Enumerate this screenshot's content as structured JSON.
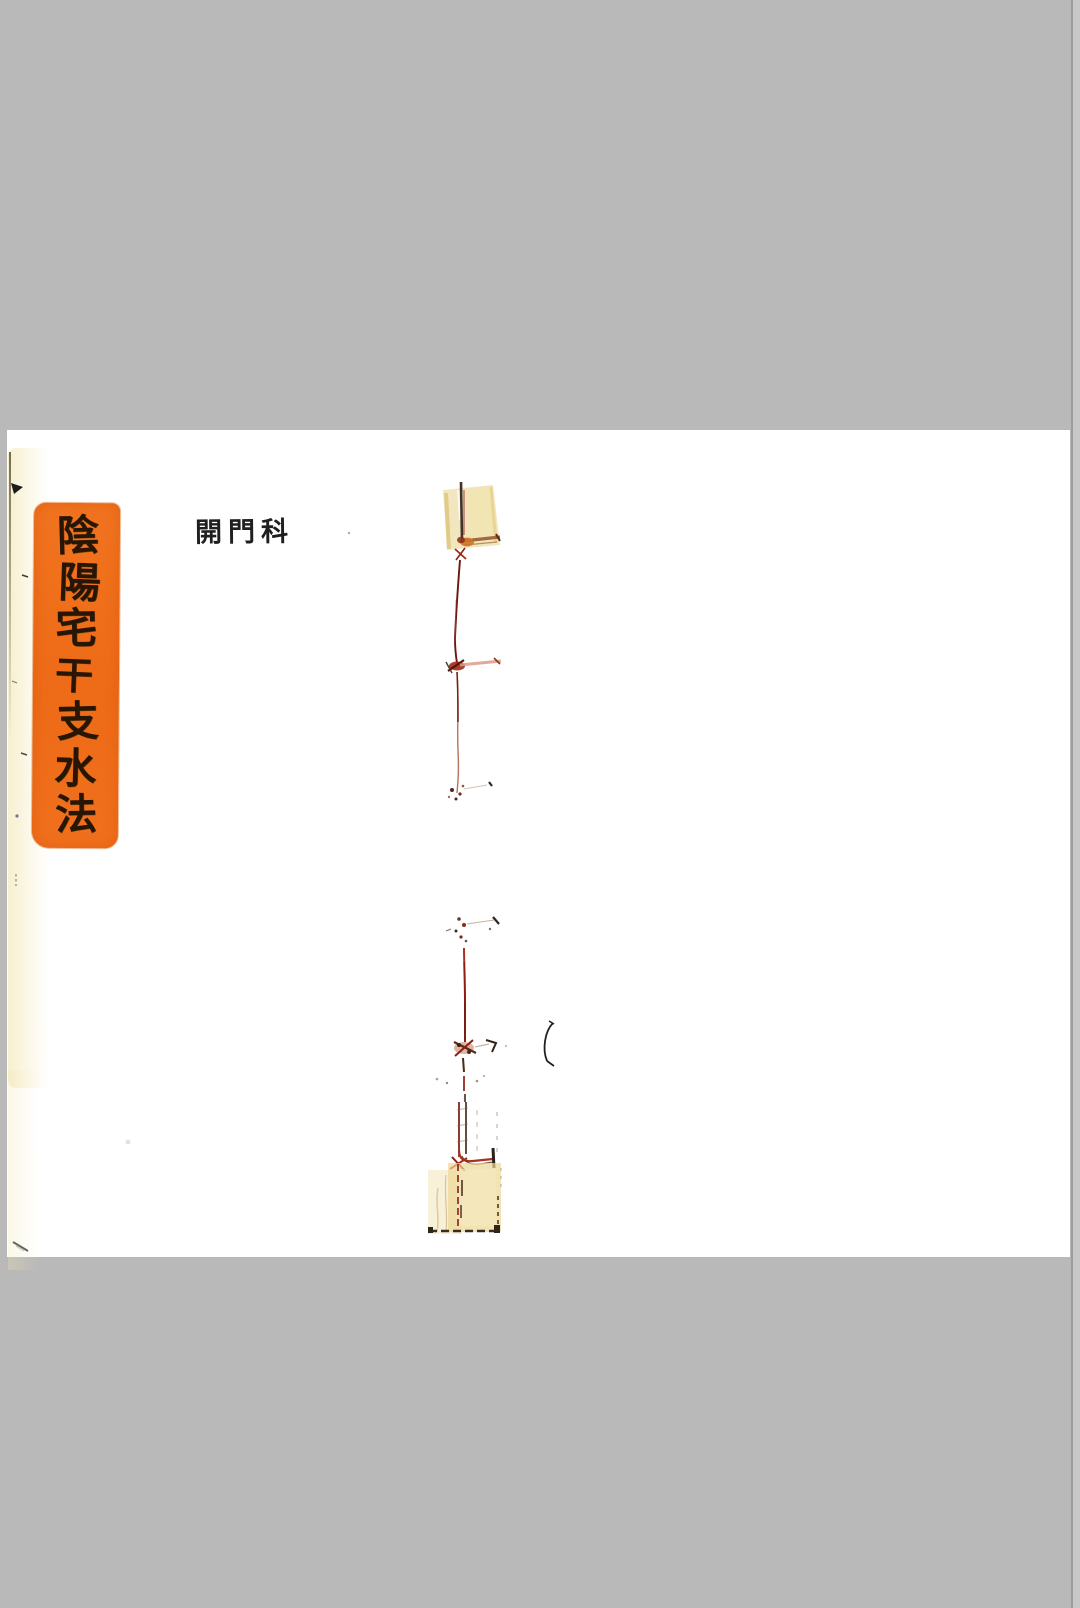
{
  "scan": {
    "background_color": "#b9b9b9",
    "paper_color": "#ffffff"
  },
  "title_label": {
    "text": "陰陽宅干支水法",
    "chars": [
      "陰",
      "陽",
      "宅",
      "干",
      "支",
      "水",
      "法"
    ],
    "background_color": "#ee6c17",
    "ink_color": "#271604"
  },
  "header_note": {
    "text": "開門科",
    "ink_color": "#1f1f1f"
  },
  "binding": {
    "thread_color": "#8a1f12",
    "tape_color": "#ead999"
  }
}
